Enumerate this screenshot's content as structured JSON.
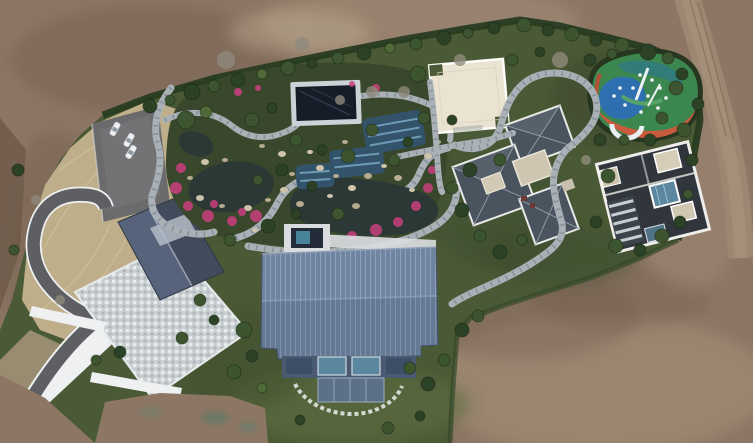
{
  "meta": {
    "title": "Aerial drone photograph of a landscaped estate",
    "description": "Top-down drone view of a luxury estate under construction: central water garden with dark ponds, blue tiled pools, pink azaleas and winding stone paths; a large slate-blue standing-seam roof building at center; a grey gable-roof building with mottled paved plaza and curved asphalt driveway at left; parking lot with three white cars; cream flat-roof pavilion; a complex of dark hip-roof buildings and a dark flat-roof modern house with glass courtyard on the right; a colourful rubber-surfaced playground top right; all surrounded by bare brown earth and a dirt road.",
    "width": 753,
    "height": 443
  },
  "palette": {
    "dirt": "#8d7664",
    "dirtlight": "#a8937c",
    "dirtdark": "#6e5a4a",
    "roaddirt": "#9c8872",
    "grass": "#4b5a36",
    "grassdark": "#39482c",
    "grasslight": "#5d6c41",
    "hedge": "#273c21",
    "dry": "#bfae8a",
    "drydark": "#a6967a",
    "asphalt": "#5e5f62",
    "parking": "#6b6b6e",
    "stone": "#a9b1b7",
    "stonetick": "#6f7880",
    "plaza": "#cbd0d3",
    "white": "#eef0f1",
    "roofblue": "#6f84a0",
    "roofslate": "#49545f",
    "roofdark": "#30363c",
    "cream": "#eae3d2",
    "water": "#2b3835",
    "pool": "#33536b",
    "poolstripe": "#6d9ab5",
    "pink": "#c9407e",
    "pgreen": "#3c874f",
    "pblue": "#2e6fb0",
    "porange": "#c75b3d",
    "car": "#eef0f2",
    "tree0": "#2c4226",
    "tree1": "#3c5530",
    "tree2": "#4f6a38",
    "tree3": "#8f897c",
    "rock0": "#cec4ab",
    "rock1": "#b7ab8f",
    "glass": "#5b87a0"
  },
  "features": [
    "dirt-field",
    "dirt-road",
    "estate-grounds",
    "hedge-border",
    "dry-grass-slope",
    "parking-lot",
    "white-cars",
    "asphalt-driveway",
    "paved-plaza",
    "west-gable-roof-building",
    "water-garden",
    "koi-ponds",
    "blue-tiled-pools",
    "dark-glass-pavilion",
    "azalea-flowers",
    "garden-rocks",
    "spa-pool",
    "main-blue-roof-building",
    "glass-facade",
    "stepping-stone-arc",
    "cream-flat-roof-building",
    "east-hip-roof-complex",
    "far-east-flat-roof-house",
    "playground",
    "stone-paths",
    "trees"
  ],
  "trees": [
    [
      150,
      106,
      7,
      0
    ],
    [
      170,
      100,
      5,
      1
    ],
    [
      192,
      92,
      8,
      0
    ],
    [
      214,
      86,
      6,
      1
    ],
    [
      238,
      80,
      7,
      0
    ],
    [
      262,
      74,
      5,
      2
    ],
    [
      288,
      68,
      7,
      1
    ],
    [
      312,
      63,
      5,
      0
    ],
    [
      338,
      58,
      6,
      1
    ],
    [
      364,
      53,
      7,
      0
    ],
    [
      390,
      48,
      5,
      2
    ],
    [
      416,
      44,
      6,
      1
    ],
    [
      444,
      38,
      7,
      0
    ],
    [
      468,
      33,
      5,
      1
    ],
    [
      494,
      28,
      6,
      0
    ],
    [
      524,
      25,
      7,
      1
    ],
    [
      548,
      30,
      6,
      0
    ],
    [
      572,
      34,
      7,
      1
    ],
    [
      596,
      40,
      6,
      0
    ],
    [
      622,
      45,
      7,
      1
    ],
    [
      648,
      52,
      8,
      0
    ],
    [
      668,
      58,
      6,
      1
    ],
    [
      186,
      120,
      9,
      1
    ],
    [
      206,
      112,
      6,
      2
    ],
    [
      252,
      120,
      7,
      1
    ],
    [
      272,
      108,
      5,
      0
    ],
    [
      296,
      140,
      6,
      1
    ],
    [
      322,
      150,
      5,
      0
    ],
    [
      348,
      156,
      7,
      1
    ],
    [
      282,
      170,
      6,
      0
    ],
    [
      258,
      180,
      5,
      1
    ],
    [
      312,
      186,
      5,
      0
    ],
    [
      338,
      214,
      6,
      1
    ],
    [
      296,
      214,
      5,
      0
    ],
    [
      394,
      160,
      6,
      1
    ],
    [
      408,
      142,
      5,
      0
    ],
    [
      372,
      130,
      6,
      1
    ],
    [
      268,
      226,
      7,
      0
    ],
    [
      230,
      240,
      6,
      1
    ],
    [
      418,
      74,
      8,
      1
    ],
    [
      404,
      92,
      6,
      3
    ],
    [
      424,
      118,
      6,
      1
    ],
    [
      452,
      120,
      5,
      0
    ],
    [
      512,
      60,
      6,
      1
    ],
    [
      540,
      52,
      5,
      0
    ],
    [
      500,
      160,
      6,
      1
    ],
    [
      470,
      170,
      7,
      0
    ],
    [
      452,
      188,
      6,
      1
    ],
    [
      462,
      210,
      7,
      0
    ],
    [
      480,
      236,
      6,
      1
    ],
    [
      500,
      252,
      7,
      0
    ],
    [
      522,
      240,
      5,
      1
    ],
    [
      600,
      140,
      6,
      0
    ],
    [
      586,
      160,
      5,
      3
    ],
    [
      608,
      176,
      7,
      1
    ],
    [
      596,
      222,
      6,
      0
    ],
    [
      616,
      246,
      7,
      1
    ],
    [
      640,
      250,
      6,
      0
    ],
    [
      662,
      236,
      7,
      1
    ],
    [
      680,
      222,
      6,
      0
    ],
    [
      688,
      194,
      5,
      1
    ],
    [
      692,
      160,
      6,
      0
    ],
    [
      684,
      130,
      7,
      1
    ],
    [
      698,
      104,
      6,
      0
    ],
    [
      676,
      88,
      7,
      1
    ],
    [
      590,
      60,
      6,
      0
    ],
    [
      612,
      54,
      5,
      1
    ],
    [
      682,
      74,
      6,
      0
    ],
    [
      662,
      118,
      6,
      1
    ],
    [
      650,
      140,
      6,
      0
    ],
    [
      624,
      140,
      5,
      1
    ],
    [
      244,
      330,
      8,
      1
    ],
    [
      252,
      356,
      6,
      0
    ],
    [
      234,
      372,
      7,
      1
    ],
    [
      262,
      388,
      5,
      2
    ],
    [
      410,
      368,
      6,
      1
    ],
    [
      428,
      384,
      7,
      0
    ],
    [
      444,
      360,
      6,
      1
    ],
    [
      462,
      330,
      7,
      0
    ],
    [
      478,
      316,
      6,
      1
    ],
    [
      300,
      420,
      5,
      0
    ],
    [
      388,
      428,
      6,
      1
    ],
    [
      420,
      416,
      5,
      0
    ],
    [
      200,
      300,
      6,
      1
    ],
    [
      214,
      320,
      5,
      0
    ],
    [
      182,
      338,
      6,
      1
    ],
    [
      120,
      352,
      6,
      0
    ],
    [
      96,
      360,
      5,
      1
    ],
    [
      60,
      300,
      5,
      3
    ],
    [
      36,
      200,
      5,
      3
    ],
    [
      18,
      170,
      6,
      0
    ],
    [
      14,
      250,
      5,
      1
    ],
    [
      226,
      60,
      9,
      3
    ],
    [
      302,
      44,
      7,
      3
    ],
    [
      560,
      60,
      8,
      3
    ],
    [
      460,
      60,
      6,
      3
    ],
    [
      372,
      92,
      6,
      3
    ],
    [
      340,
      100,
      5,
      3
    ]
  ],
  "rocks": [
    [
      205,
      162,
      4,
      0
    ],
    [
      190,
      178,
      3,
      1
    ],
    [
      200,
      198,
      4,
      0
    ],
    [
      222,
      206,
      3,
      1
    ],
    [
      248,
      208,
      4,
      0
    ],
    [
      268,
      200,
      3,
      1
    ],
    [
      284,
      190,
      4,
      0
    ],
    [
      292,
      174,
      3,
      1
    ],
    [
      282,
      154,
      4,
      0
    ],
    [
      262,
      146,
      3,
      1
    ],
    [
      320,
      168,
      4,
      0
    ],
    [
      336,
      176,
      3,
      1
    ],
    [
      352,
      188,
      4,
      0
    ],
    [
      368,
      176,
      4,
      1
    ],
    [
      384,
      166,
      3,
      0
    ],
    [
      398,
      178,
      4,
      1
    ],
    [
      412,
      190,
      3,
      0
    ],
    [
      356,
      206,
      4,
      1
    ],
    [
      330,
      196,
      3,
      0
    ],
    [
      300,
      204,
      4,
      1
    ],
    [
      428,
      156,
      4,
      0
    ],
    [
      438,
      142,
      3,
      1
    ],
    [
      310,
      152,
      3,
      0
    ],
    [
      345,
      142,
      3,
      1
    ],
    [
      255,
      230,
      3,
      0
    ],
    [
      225,
      160,
      3,
      1
    ]
  ],
  "flowers": [
    [
      181,
      168,
      5
    ],
    [
      176,
      188,
      6
    ],
    [
      188,
      206,
      5
    ],
    [
      208,
      216,
      6
    ],
    [
      232,
      221,
      5
    ],
    [
      256,
      216,
      6
    ],
    [
      300,
      236,
      5
    ],
    [
      326,
      242,
      6
    ],
    [
      352,
      236,
      5
    ],
    [
      376,
      230,
      6
    ],
    [
      398,
      222,
      5
    ],
    [
      416,
      206,
      5
    ],
    [
      428,
      188,
      5
    ],
    [
      432,
      170,
      4
    ],
    [
      238,
      92,
      4
    ],
    [
      258,
      88,
      3
    ],
    [
      376,
      88,
      4
    ],
    [
      352,
      84,
      3
    ],
    [
      214,
      204,
      4
    ],
    [
      242,
      212,
      4
    ]
  ],
  "cars": [
    [
      115,
      129,
      -62
    ],
    [
      129,
      140,
      -60
    ],
    [
      131,
      152,
      -58
    ]
  ],
  "playground_dots": [
    [
      640,
      75
    ],
    [
      652,
      80
    ],
    [
      660,
      88
    ],
    [
      633,
      88
    ],
    [
      648,
      96
    ],
    [
      666,
      98
    ],
    [
      625,
      105
    ],
    [
      658,
      108
    ],
    [
      641,
      112
    ],
    [
      614,
      96
    ],
    [
      620,
      88
    ]
  ]
}
